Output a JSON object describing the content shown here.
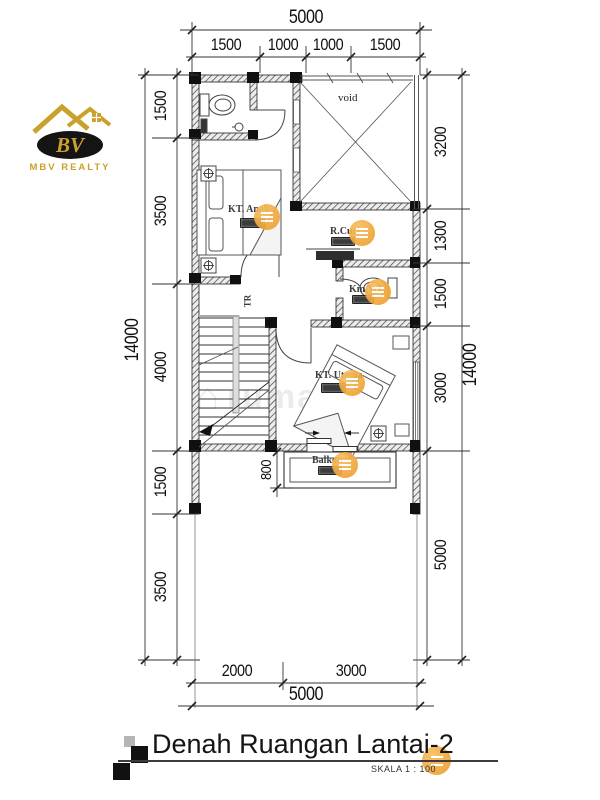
{
  "logo": {
    "monogram": "BV",
    "company": "MBV REALTY"
  },
  "watermark": {
    "text": "rumande"
  },
  "plan": {
    "rooms": {
      "void": "void",
      "kt_anak": "KT. Anak",
      "r_cuci": "R.Cuci",
      "km_wc": "Km/WC",
      "kt_utama": "KT. Utama",
      "balkon": "Balkon",
      "stairs": "TR"
    }
  },
  "dimensions": {
    "top": {
      "overall": "5000",
      "segments": [
        "1500",
        "1000",
        "1000",
        "1500"
      ]
    },
    "left": {
      "overall": "14000",
      "segments": [
        "1500",
        "3500",
        "4000",
        "1500",
        "3500"
      ]
    },
    "right": {
      "overall": "14000",
      "segments": [
        "3200",
        "1300",
        "1500",
        "3000",
        "5000"
      ]
    },
    "bottom": {
      "overall": "5000",
      "segments": [
        "2000",
        "3000"
      ]
    },
    "balcony_depth": "800"
  },
  "title_block": {
    "title": "Denah Ruangan Lantai-2",
    "scale": "SKALA 1 : 100"
  },
  "colors": {
    "accent_orange": "#F0A437",
    "logo_gold": "#C9A12B",
    "line": "#222222"
  }
}
